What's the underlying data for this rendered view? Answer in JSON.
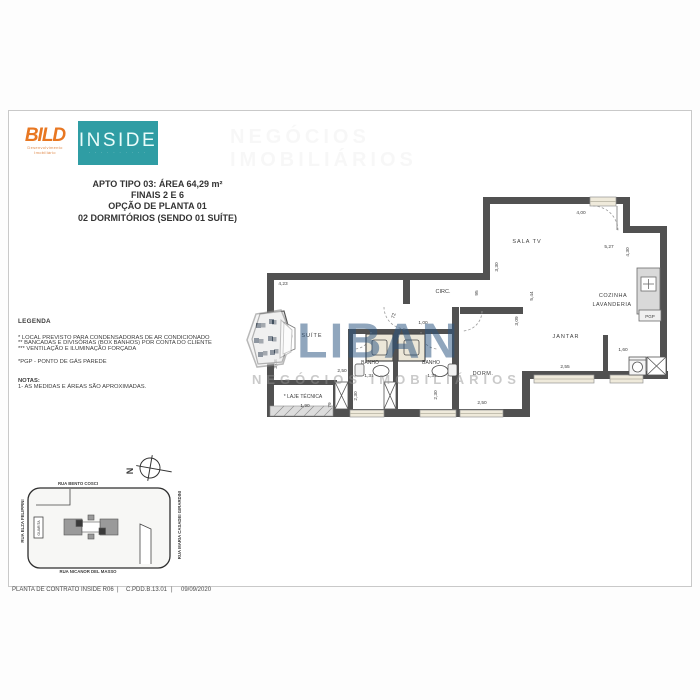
{
  "colors": {
    "bild_orange": "#e87722",
    "inside_teal": "#2f9da4",
    "wall_gray": "#515151",
    "watermark_blue": "#2a5480"
  },
  "header": {
    "bild": {
      "word": "BILD",
      "sub1": "Desenvolvimento",
      "sub2": "Imobiliário"
    },
    "inside": {
      "word": "INSIDE",
      "tagline": "· · · · · · · · · ·"
    }
  },
  "title_block": {
    "lines": [
      "APTO TIPO 03: ÁREA 64,29 m²",
      "FINAIS 2 E 6",
      "OPÇÃO DE PLANTA 01",
      "02 DORMITÓRIOS (SENDO 01 SUÍTE)"
    ]
  },
  "legend": {
    "heading": "LEGENDA",
    "items": [
      "*   LOCAL PREVISTO PARA CONDENSADORAS DE AR CONDICIONADO",
      "**  BANCADAS E DIVISÓRIAS (BOX BANHOS) POR CONTA DO CLIENTE",
      "*** VENTILAÇÃO E ILUMINAÇÃO FORÇADA"
    ],
    "pgp_note": "*PGP - PONTO DE GÁS PAREDE",
    "notas_heading": "NOTAS:",
    "nota1": "1- AS MEDIDAS E ÁREAS SÃO APROXIMADAS."
  },
  "watermark": {
    "text": "LIBAN",
    "subtext": "NEGÓCIOS IMOBILIÁRIOS"
  },
  "floorplan": {
    "pgp_label": "PGP",
    "rooms": [
      {
        "id": "room-sala-tv",
        "label": "SALA TV"
      },
      {
        "id": "room-circ",
        "label": "CIRC."
      },
      {
        "id": "room-cozinha",
        "label": "COZINHA"
      },
      {
        "id": "room-lavanderia",
        "label": "LAVANDERIA"
      },
      {
        "id": "room-jantar",
        "label": "JANTAR"
      },
      {
        "id": "room-dorm",
        "label": "DORM."
      },
      {
        "id": "room-suite",
        "label": "SUÍTE"
      },
      {
        "id": "room-banho-1",
        "label": "BANHO"
      },
      {
        "id": "room-banho-2",
        "label": "BANHO"
      },
      {
        "id": "room-laje-tecnica",
        "label": "* LAJE TÉCNICA"
      }
    ],
    "dims": [
      {
        "id": "dim-4-00",
        "text": "4,00"
      },
      {
        "id": "dim-5-27",
        "text": "5,27"
      },
      {
        "id": "dim-4-30",
        "text": "4,30"
      },
      {
        "id": "dim-3-30",
        "text": "3,30"
      },
      {
        "id": "dim-95",
        "text": "95"
      },
      {
        "id": "dim-5-44",
        "text": "5,44"
      },
      {
        "id": "dim-3-09",
        "text": "3,09"
      },
      {
        "id": "dim-4-23",
        "text": "4,23"
      },
      {
        "id": "dim-72",
        "text": "72"
      },
      {
        "id": "dim-1-00",
        "text": "1,00"
      },
      {
        "id": "dim-2-50-suite",
        "text": "2,50"
      },
      {
        "id": "dim-1-31-a",
        "text": "1,31"
      },
      {
        "id": "dim-1-31-b",
        "text": "1,31"
      },
      {
        "id": "dim-2-30-a",
        "text": "2,30"
      },
      {
        "id": "dim-2-30-b",
        "text": "2,30"
      },
      {
        "id": "dim-1-90",
        "text": "1,90"
      },
      {
        "id": "dim-79",
        "text": "79"
      },
      {
        "id": "dim-3-08",
        "text": "3,08"
      },
      {
        "id": "dim-2-50-dorm",
        "text": "2,50"
      },
      {
        "id": "dim-2-55",
        "text": "2,55"
      },
      {
        "id": "dim-1-60",
        "text": "1,60"
      }
    ]
  },
  "sitemap": {
    "streets": {
      "top": "RUA BENTO COSCI",
      "bottom": "RUA NICANOR DEL MASSO",
      "left": "RUA ELZA FELIPPINI",
      "right": "RUA MARIA CASADEI GIRARDINI"
    },
    "guarita": "GUARITA",
    "compass_letter": "N"
  },
  "footer": {
    "left": "PLANTA DE CONTRATO INSIDE R06",
    "sep": "|",
    "code": "C.PDD.B.13.01",
    "date": "09/09/2020"
  }
}
